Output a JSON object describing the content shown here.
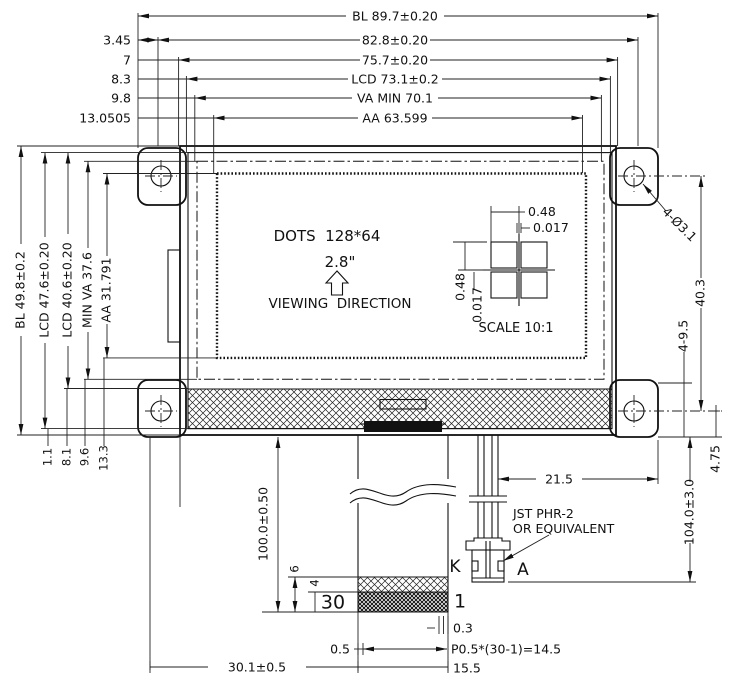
{
  "title": "LCD module outline drawing",
  "dims": {
    "top": [
      "BL 89.7±0.20",
      "82.8±0.20",
      "75.7±0.20",
      "LCD 73.1±0.2",
      "VA MIN 70.1",
      "AA 63.599"
    ],
    "top_offsets": [
      "3.45",
      "7",
      "8.3",
      "9.8",
      "13.0505"
    ],
    "left": [
      "BL 49.8±0.2",
      "LCD 47.6±0.20",
      "LCD 40.6±0.20",
      "MIN VA 37.6",
      "AA 31.791"
    ],
    "bottom_offsets": [
      "1.1",
      "8.1",
      "9.6",
      "13.3"
    ],
    "right": {
      "holes": "4-Ø3.1",
      "hole_spacing": "40.3",
      "tab": "4-9.5",
      "edge": "4.75",
      "overall": "104.0±3.0",
      "wires": "21.5"
    },
    "bottom": {
      "fpc_length": "100.0±0.50",
      "band_a": "6",
      "band_b": "4",
      "pin_last": "30",
      "pin_first": "1",
      "contact_w": "0.3",
      "margin": "0.5",
      "pitch": "P0.5*(30-1)=14.5",
      "tail_w": "15.5",
      "tail_pos": "30.1±0.5"
    }
  },
  "display": {
    "dots": "DOTS  128*64",
    "size": "2.8\"",
    "viewing": "VIEWING  DIRECTION"
  },
  "detail": {
    "w": "0.48",
    "gap_w": "0.017",
    "h": "0.48",
    "gap_h": "0.017",
    "scale": "SCALE 10:1"
  },
  "connector": {
    "line1": "JST PHR-2",
    "line2": "OR EQUIVALENT",
    "cathode": "K",
    "anode": "A"
  }
}
